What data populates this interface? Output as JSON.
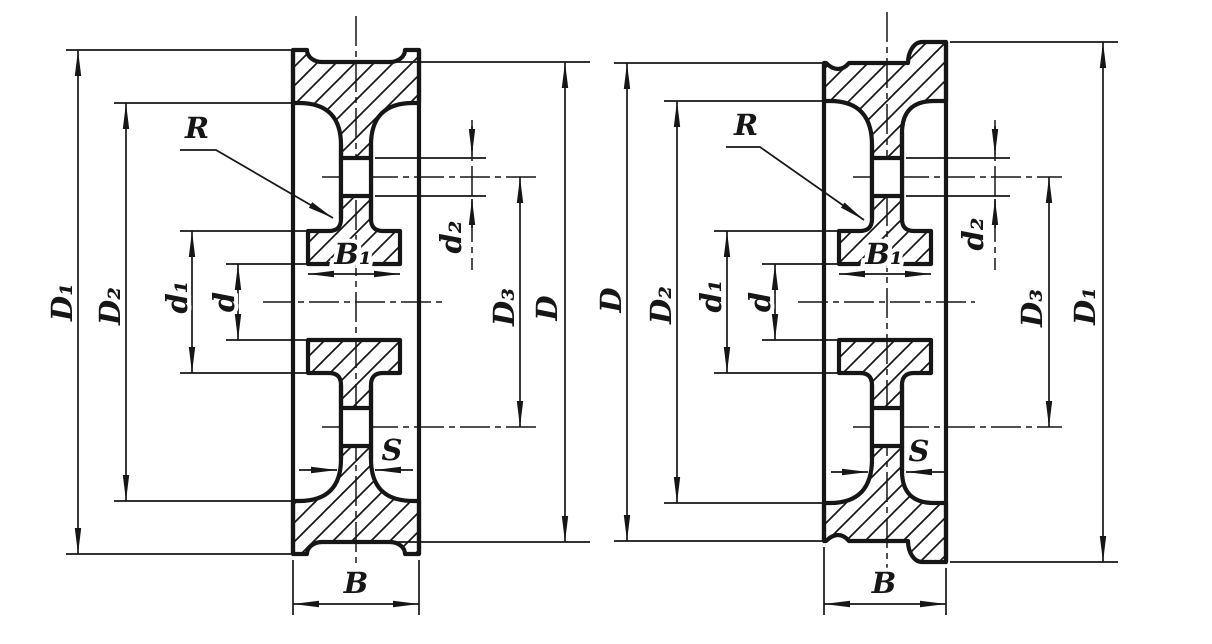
{
  "drawing": {
    "background_color": "#ffffff",
    "ink_color": "#161616",
    "figures": [
      {
        "name": "double-flanged-wheel-section",
        "labels": {
          "D1": "D₁",
          "D2": "D₂",
          "d1": "d₁",
          "d": "d",
          "R": "R",
          "B1": "B₁",
          "d2": "d₂",
          "D3": "D₃",
          "D": "D",
          "S": "S",
          "B": "B"
        }
      },
      {
        "name": "single-flanged-wheel-section",
        "labels": {
          "D": "D",
          "D2": "D₂",
          "d1": "d₁",
          "d": "d",
          "R": "R",
          "B1": "B₁",
          "d2": "d₂",
          "D3": "D₃",
          "D1": "D₁",
          "S": "S",
          "B": "B"
        }
      }
    ]
  }
}
